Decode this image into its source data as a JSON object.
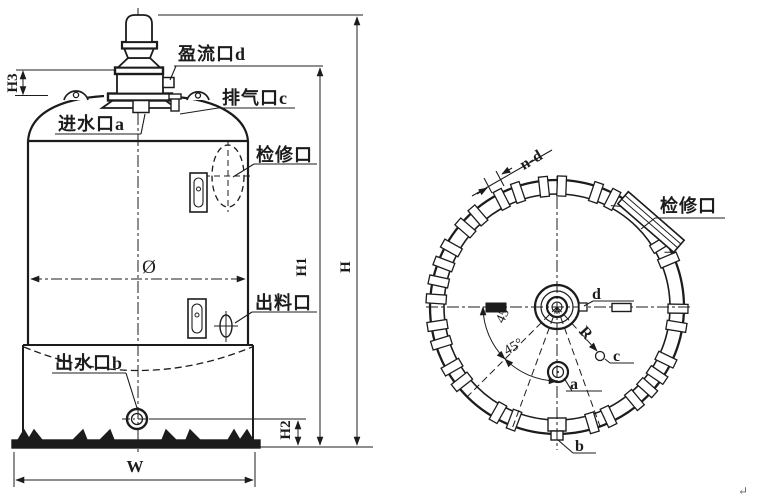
{
  "front_view": {
    "port_labels": {
      "overflow": "盈流口d",
      "vent": "排气口c",
      "inlet": "进水口a",
      "manhole": "检修口",
      "discharge": "出料口",
      "outlet": "出水口b"
    },
    "dim_labels": {
      "h": "H",
      "h1": "H1",
      "h2": "H2",
      "h3": "H3",
      "w": "W",
      "diameter": "Ø"
    }
  },
  "top_view": {
    "labels": {
      "manhole": "检修口",
      "slot_dim": "n-d",
      "angle_left": "45°",
      "angle_bottom": "45°",
      "radius": "R",
      "port_a": "a",
      "port_b": "b",
      "port_c": "c",
      "port_d": "d"
    },
    "notch_angles_deg": [
      27,
      67,
      92,
      113,
      135,
      155,
      172,
      193,
      214,
      245,
      291,
      314,
      330,
      355
    ],
    "notch_pair_half_angle_deg": 4.2
  },
  "artifact": {
    "return_mark": "↵"
  },
  "colors": {
    "ink": "#1c1c1c",
    "background": "#ffffff"
  }
}
